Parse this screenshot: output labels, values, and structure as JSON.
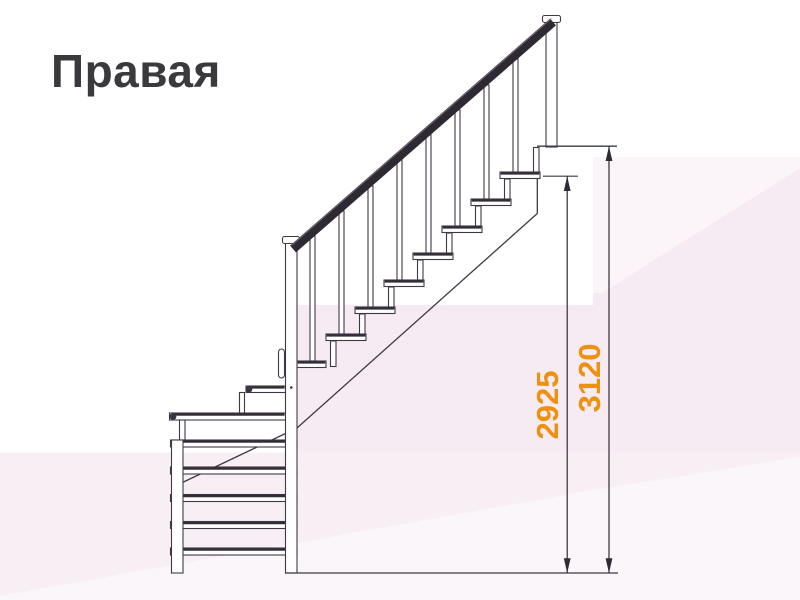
{
  "title": "Правая",
  "dimensions": {
    "left": "2925",
    "right": "3120"
  },
  "colors": {
    "dimension_text": "#ee9110",
    "drawing_lines": "#3f3945",
    "handrail": "#2e2933",
    "background_pink": "#f7ebf3",
    "title_text": "#3a393d"
  }
}
